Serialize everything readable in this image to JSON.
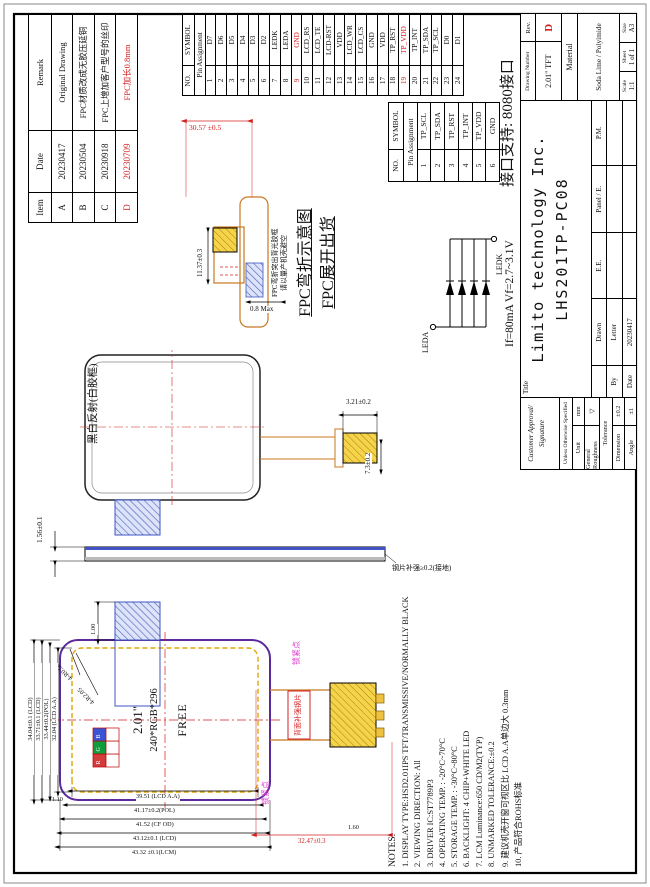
{
  "revision": {
    "h_item": "Item",
    "h_date": "Date",
    "h_remark": "Remark",
    "rows": [
      {
        "item": "A",
        "date": "20230417",
        "remark": "Original Drawing",
        "red": false
      },
      {
        "item": "B",
        "date": "20230504",
        "remark": "FPC材质改成无胶压延铜",
        "red": false
      },
      {
        "item": "C",
        "date": "20230918",
        "remark": "FPC上增加客户型号的丝印",
        "red": false
      },
      {
        "item": "D",
        "date": "20230709",
        "remark": "FPC加长0.8mm",
        "red": true
      }
    ]
  },
  "pin_table_24": {
    "h_no": "NO.",
    "h_symbol": "SYMBOL",
    "subheader": "Pin Assignment",
    "pins": [
      {
        "no": "1",
        "symbol": "D7",
        "red": false
      },
      {
        "no": "2",
        "symbol": "D6",
        "red": false
      },
      {
        "no": "3",
        "symbol": "D5",
        "red": false
      },
      {
        "no": "4",
        "symbol": "D4",
        "red": false
      },
      {
        "no": "5",
        "symbol": "D3",
        "red": false
      },
      {
        "no": "6",
        "symbol": "D2",
        "red": false
      },
      {
        "no": "7",
        "symbol": "LEDK",
        "red": false
      },
      {
        "no": "8",
        "symbol": "LEDA",
        "red": false
      },
      {
        "no": "9",
        "symbol": "GND",
        "red": true
      },
      {
        "no": "10",
        "symbol": "LCD_RS",
        "red": false
      },
      {
        "no": "11",
        "symbol": "LCD_TE",
        "red": false
      },
      {
        "no": "12",
        "symbol": "LCD-RST",
        "red": false
      },
      {
        "no": "13",
        "symbol": "VDD",
        "red": false
      },
      {
        "no": "14",
        "symbol": "LCD_WR",
        "red": false
      },
      {
        "no": "15",
        "symbol": "LCD_CS",
        "red": false
      },
      {
        "no": "16",
        "symbol": "GND",
        "red": false
      },
      {
        "no": "17",
        "symbol": "VDD",
        "red": false
      },
      {
        "no": "18",
        "symbol": "TP_RST",
        "red": false
      },
      {
        "no": "19",
        "symbol": "TP_VDD",
        "red": true
      },
      {
        "no": "20",
        "symbol": "TP_INT",
        "red": false
      },
      {
        "no": "21",
        "symbol": "TP_SDA",
        "red": false
      },
      {
        "no": "22",
        "symbol": "TP_SCL",
        "red": false
      },
      {
        "no": "23",
        "symbol": "D0",
        "red": false
      },
      {
        "no": "24",
        "symbol": "D1",
        "red": false
      }
    ]
  },
  "pin_table_6": {
    "h_no": "NO.",
    "h_symbol": "SYMBOL",
    "subheader": "Pin Assignment",
    "pins": [
      {
        "no": "1",
        "symbol": "TP_SCL",
        "red": false
      },
      {
        "no": "2",
        "symbol": "TP_SDA",
        "red": false
      },
      {
        "no": "3",
        "symbol": "TP_RST",
        "red": false
      },
      {
        "no": "4",
        "symbol": "TP_INT",
        "red": false
      },
      {
        "no": "5",
        "symbol": "TP_VDD",
        "red": false
      },
      {
        "no": "6",
        "symbol": "GND",
        "red": false
      }
    ]
  },
  "interface_note": "接口支持: 8080接口",
  "titleblock": {
    "customer_line1": "Customer Approval/",
    "customer_line2": "Signature",
    "spec_header": "Unless Otherwise Specified",
    "unit_label": "Unit",
    "unit_value": "mm",
    "roughness_label": "General Roughness",
    "roughness_symbol": "▽",
    "tolerance_label": "Tolerance",
    "dimension_label": "Dimension",
    "dimension_value": "±0.2",
    "angle_label": "Angle",
    "angle_value": "±1",
    "title_label": "Title",
    "company": "Limito technology Inc.",
    "model": "LHS201TP-PC08",
    "by_label": "By",
    "date_label": "Date",
    "col_drawn": "Drawn",
    "col_ee": "E.E.",
    "col_panel": "Panel / E.",
    "col_pm": "P.M.",
    "drawn_by": "Letter",
    "drawn_date": "20230417",
    "drawing_number_label": "Drawing Number",
    "drawing_number": "2.01\" TFT",
    "rev_label": "Rev.",
    "rev_value": "D",
    "material_label": "Material",
    "material_value": "Soda Lime / Polyimide",
    "scale_label": "Scale",
    "scale_value": "1:1",
    "sheet_label": "Sheet",
    "sheet_value": "1 of 1",
    "size_label": "Size",
    "size_value": "A3"
  },
  "led_circuit": {
    "anode_label": "LEDA",
    "cathode_label": "LEDK",
    "spec_text": "If=80mA  Vf=2.7~3.1V"
  },
  "fpc_view": {
    "title1": "FPC弯折示意图",
    "title2": "FPC展开出货",
    "note_line1": "FPC弯折突出背光胶框",
    "note_line2": "请以量产机壳避空",
    "dim_width": "30.57 ±0.5",
    "dim_height": "11.37±0.3",
    "dim_thickness": "0.8 Max"
  },
  "bw_view": {
    "label": "黑白反射(白胶框)",
    "dim_tail_w": "3.21±0.2",
    "dim_tail_l": "7.3±0.2"
  },
  "side_view": {
    "dim_thickness": "1.56±0.1",
    "note": "钢片补强≥0.2(接地)"
  },
  "front_view": {
    "size_label": "2.01\"",
    "resolution": "240*RGB*296",
    "free_label": "FREE",
    "corner_r1": "4-R0.50",
    "corner_r2": "4-R2.05",
    "rgb": [
      "R",
      "G",
      "B"
    ],
    "dims_top": [
      "34.04±0.1 (LCD)",
      "33.71±0.1 (LCD)",
      "33.44±0.2(POL)",
      "32.04 (LCD A.A)"
    ],
    "dims_left": [
      "39.51 (LCD A.A)",
      "41.17±0.2(POL)",
      "41.52 (CF OD)",
      "43.12±0.1 (LCD)",
      "43.32 ±0.1(LCM)"
    ],
    "dim_tab": "1.00",
    "dim_110": "1.10",
    "dim_160": "1.60",
    "dim_red": "32.47±0.3",
    "lock_label1": "锁紧点",
    "lock_label2": "锁紧点",
    "fpc_label": "背面补强钢片"
  },
  "notes": {
    "title": "NOTES:",
    "items": [
      "1. DISPLAY TYPE:HSD2.01IPS TFT/TRANSMISSIVE/NORMALLY BLACK",
      "2. VIEWING DIRECTION: All",
      "3. DRIVER IC:ST7789P3",
      "4. OPERATING TEMP. :  -20°C~70°C",
      "5. STORAGE TEMP. :  -30°C~80°C",
      "6. BACKLIGHT: 4 CHIP+WHITE LED",
      "7. LCM Luminance:650 CD/M2(TYP)",
      "8. UNMARKED TOLERANCE:±0.2",
      "9. 建议机壳开窗可视区比 LCD A.A单边大 0.3mm",
      "10. 产品符合ROHS标准"
    ]
  }
}
